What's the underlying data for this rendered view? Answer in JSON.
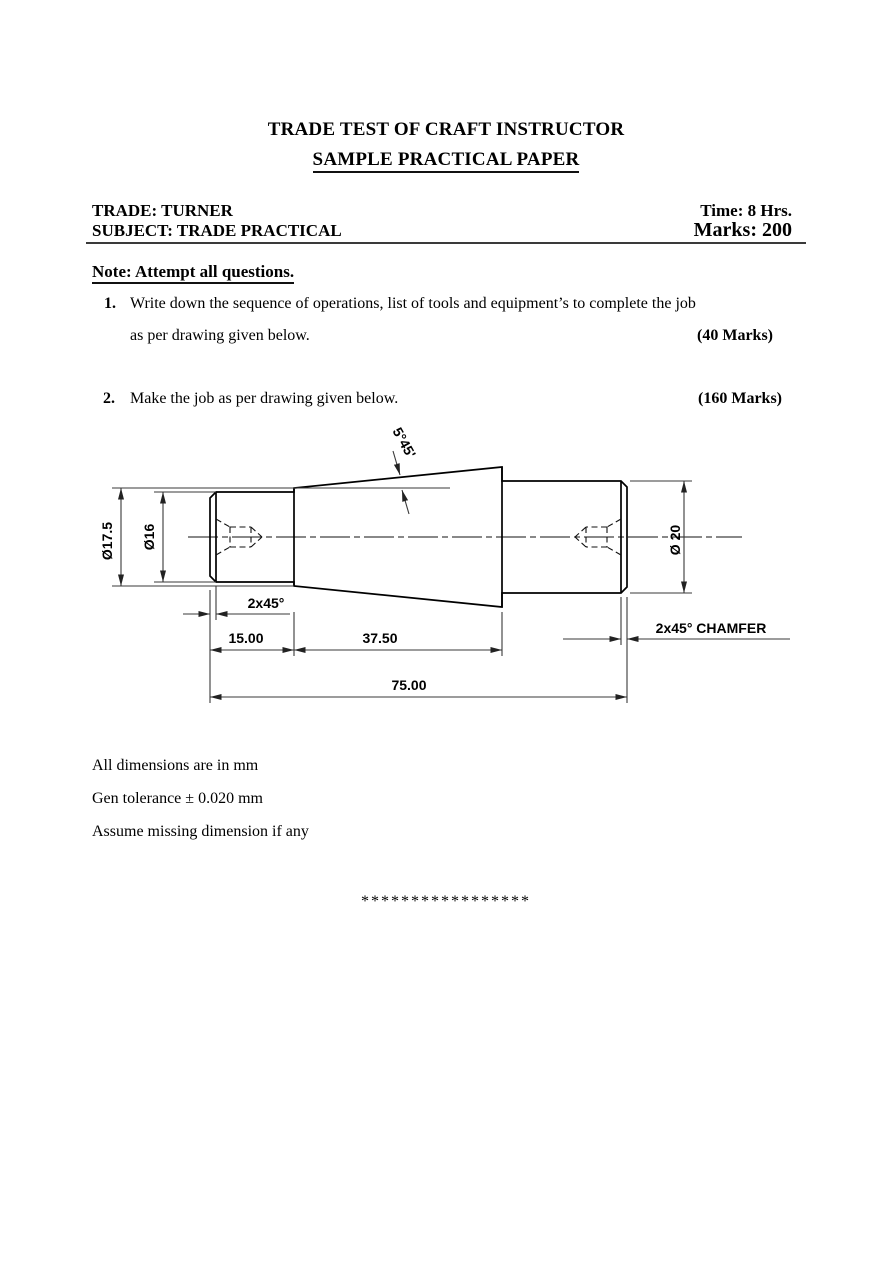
{
  "header": {
    "title": "TRADE TEST OF CRAFT INSTRUCTOR",
    "subtitle": "SAMPLE PRACTICAL PAPER",
    "trade": "TRADE: TURNER",
    "time": "Time: 8 Hrs.",
    "subject": "SUBJECT: TRADE PRACTICAL",
    "marks": "Marks: 200",
    "note": "Note: Attempt all questions."
  },
  "questions": [
    {
      "number": "1.",
      "line1": "Write down the sequence of operations, list of tools and equipment’s to complete the job",
      "line2": "as per drawing given below.",
      "marks": "(40 Marks)"
    },
    {
      "number": "2.",
      "line1": "Make the job as per drawing given below.",
      "marks": "(160 Marks)"
    }
  ],
  "drawing": {
    "labels": {
      "taper_angle": "5°45'",
      "dia_outer_left": "Ø17.5",
      "dia_inner_left": "Ø16",
      "dia_right": "Ø 20",
      "chamfer_left": "2x45°",
      "chamfer_right": "2x45° CHAMFER",
      "length_left": "15.00",
      "length_taper": "37.50",
      "length_overall": "75.00"
    }
  },
  "footer": {
    "notes": [
      "All dimensions are in mm",
      "Gen tolerance ± 0.020 mm",
      "Assume missing dimension if any"
    ],
    "separator": "*****************"
  }
}
